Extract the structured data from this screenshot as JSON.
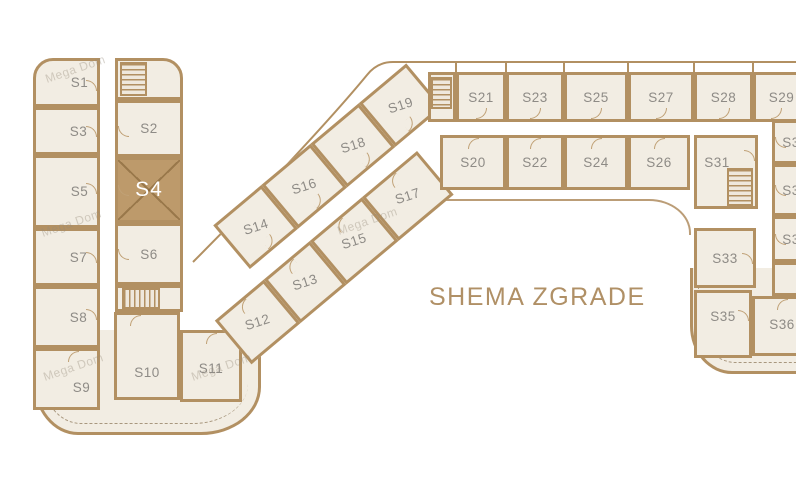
{
  "title": "SHEMA ZGRADE",
  "watermark": "Mega Dom",
  "highlighted_unit": "S4",
  "colors": {
    "wall": "#b29062",
    "floor": "#f2ede3",
    "highlight": "#bd9a6b",
    "highlight_text": "#ffffff",
    "unit_label": "#8e8b86",
    "title_text": "#b09066"
  },
  "wings": [
    {
      "name": "left-wing",
      "rooms": [
        {
          "label": "S1",
          "x": 33,
          "y": 58,
          "w": 67,
          "h": 49,
          "rtl": 20,
          "door": [
            "right",
            0.55
          ],
          "lx": 13
        },
        {
          "label": "S3",
          "x": 33,
          "y": 107,
          "w": 67,
          "h": 48,
          "door": [
            "right",
            0.5
          ],
          "lx": 12
        },
        {
          "label": "S5",
          "x": 33,
          "y": 155,
          "w": 67,
          "h": 73,
          "door": [
            "right",
            0.45
          ],
          "lx": 13
        },
        {
          "label": "S7",
          "x": 33,
          "y": 228,
          "w": 67,
          "h": 58,
          "door": [
            "right",
            0.5
          ],
          "lx": 12
        },
        {
          "label": "S8",
          "x": 33,
          "y": 286,
          "w": 67,
          "h": 62,
          "door": [
            "right",
            0.45
          ],
          "lx": 12
        },
        {
          "label": "S9",
          "x": 33,
          "y": 348,
          "w": 67,
          "h": 62,
          "door": [
            "top",
            0.6
          ],
          "lx": 15,
          "ly": 8
        },
        {
          "label": "",
          "x": 115,
          "y": 58,
          "w": 68,
          "h": 42,
          "rtr": 20
        },
        {
          "label": "S2",
          "x": 115,
          "y": 100,
          "w": 68,
          "h": 57,
          "door": [
            "left",
            0.55
          ]
        },
        {
          "label": "S4",
          "x": 115,
          "y": 157,
          "w": 68,
          "h": 66,
          "hl": true,
          "door": [
            "left",
            0.5
          ]
        },
        {
          "label": "S6",
          "x": 115,
          "y": 223,
          "w": 68,
          "h": 62,
          "door": [
            "left",
            0.5
          ]
        },
        {
          "label": "",
          "x": 115,
          "y": 285,
          "w": 68,
          "h": 27
        },
        {
          "label": "S10",
          "x": 114,
          "y": 312,
          "w": 66,
          "h": 88,
          "door": [
            "top",
            0.3
          ],
          "ly": 16
        },
        {
          "label": "S11",
          "x": 180,
          "y": 330,
          "w": 62,
          "h": 72,
          "door": [
            "top",
            0.5
          ],
          "ly": 2
        }
      ]
    },
    {
      "name": "diagonal-wing",
      "angle": -40,
      "ox": 120,
      "oy": 301,
      "cw": 380,
      "ch": 145,
      "labelAngle": 22,
      "rooms": [
        {
          "label": "S14",
          "x": 120,
          "y": 2,
          "w": 63,
          "h": 57,
          "door": [
            "bottom",
            0.5
          ]
        },
        {
          "label": "S16",
          "x": 183,
          "y": 2,
          "w": 64,
          "h": 57,
          "door": [
            "bottom",
            0.5
          ]
        },
        {
          "label": "S18",
          "x": 247,
          "y": 2,
          "w": 63,
          "h": 57,
          "door": [
            "bottom",
            0.5
          ]
        },
        {
          "label": "S19",
          "x": 310,
          "y": 2,
          "w": 62,
          "h": 57,
          "door": [
            "bottom",
            0.4
          ]
        },
        {
          "label": "S12",
          "x": 60,
          "y": 76,
          "w": 64,
          "h": 57,
          "door": [
            "top",
            0.5
          ]
        },
        {
          "label": "S13",
          "x": 124,
          "y": 76,
          "w": 60,
          "h": 57,
          "door": [
            "top",
            0.5
          ]
        },
        {
          "label": "S15",
          "x": 184,
          "y": 76,
          "w": 68,
          "h": 57,
          "door": [
            "top",
            0.5
          ]
        },
        {
          "label": "S17",
          "x": 252,
          "y": 76,
          "w": 72,
          "h": 57,
          "door": [
            "top",
            0.5
          ]
        }
      ]
    },
    {
      "name": "top-wing",
      "rooms": [
        {
          "label": "",
          "x": 428,
          "y": 72,
          "w": 28,
          "h": 50
        },
        {
          "label": "S21",
          "x": 456,
          "y": 72,
          "w": 50,
          "h": 50,
          "door": [
            "bottom",
            0.5
          ]
        },
        {
          "label": "S23",
          "x": 506,
          "y": 72,
          "w": 58,
          "h": 50,
          "door": [
            "bottom",
            0.5
          ]
        },
        {
          "label": "S25",
          "x": 564,
          "y": 72,
          "w": 64,
          "h": 50,
          "door": [
            "bottom",
            0.5
          ]
        },
        {
          "label": "S27",
          "x": 628,
          "y": 72,
          "w": 66,
          "h": 50,
          "door": [
            "bottom",
            0.5
          ]
        },
        {
          "label": "S28",
          "x": 694,
          "y": 72,
          "w": 59,
          "h": 50,
          "door": [
            "bottom",
            0.5
          ]
        },
        {
          "label": "S29",
          "x": 753,
          "y": 72,
          "w": 57,
          "h": 50,
          "door": [
            "bottom",
            0.4
          ]
        },
        {
          "label": "S20",
          "x": 440,
          "y": 135,
          "w": 66,
          "h": 55,
          "door": [
            "top",
            0.5
          ]
        },
        {
          "label": "S22",
          "x": 506,
          "y": 135,
          "w": 58,
          "h": 55,
          "door": [
            "top",
            0.5
          ]
        },
        {
          "label": "S24",
          "x": 564,
          "y": 135,
          "w": 64,
          "h": 55,
          "door": [
            "top",
            0.5
          ]
        },
        {
          "label": "S26",
          "x": 628,
          "y": 135,
          "w": 62,
          "h": 55,
          "door": [
            "top",
            0.5
          ]
        }
      ]
    },
    {
      "name": "right-wing",
      "rooms": [
        {
          "label": "S31",
          "x": 694,
          "y": 135,
          "w": 64,
          "h": 74,
          "door": [
            "right",
            0.25
          ],
          "lx": -9,
          "ly": -10
        },
        {
          "label": "S30",
          "x": 772,
          "y": 120,
          "w": 46,
          "h": 44,
          "door": [
            "left",
            0.5
          ]
        },
        {
          "label": "S32",
          "x": 772,
          "y": 164,
          "w": 46,
          "h": 52,
          "door": [
            "left",
            0.5
          ]
        },
        {
          "label": "S34",
          "x": 772,
          "y": 216,
          "w": 46,
          "h": 46,
          "door": [
            "left",
            0.5
          ]
        },
        {
          "label": "",
          "x": 772,
          "y": 262,
          "w": 46,
          "h": 34
        },
        {
          "label": "S33",
          "x": 694,
          "y": 228,
          "w": 62,
          "h": 60,
          "door": [
            "right",
            0.5
          ]
        },
        {
          "label": "S35",
          "x": 694,
          "y": 290,
          "w": 58,
          "h": 68,
          "door": [
            "right",
            0.35
          ],
          "ly": -8
        },
        {
          "label": "S36",
          "x": 752,
          "y": 296,
          "w": 60,
          "h": 60,
          "door": [
            "top",
            0.5
          ],
          "ly": -2
        }
      ]
    }
  ],
  "stairs": [
    {
      "x": 120,
      "y": 62,
      "w": 27,
      "h": 34,
      "dir": "h"
    },
    {
      "x": 122,
      "y": 288,
      "w": 38,
      "h": 21,
      "dir": "v"
    },
    {
      "x": 431,
      "y": 77,
      "w": 21,
      "h": 32,
      "dir": "h"
    },
    {
      "x": 727,
      "y": 168,
      "w": 26,
      "h": 38,
      "dir": "h"
    }
  ],
  "watermarks": [
    {
      "x": 44,
      "y": 62
    },
    {
      "x": 40,
      "y": 216
    },
    {
      "x": 42,
      "y": 360
    },
    {
      "x": 190,
      "y": 360
    },
    {
      "x": 336,
      "y": 214
    }
  ]
}
